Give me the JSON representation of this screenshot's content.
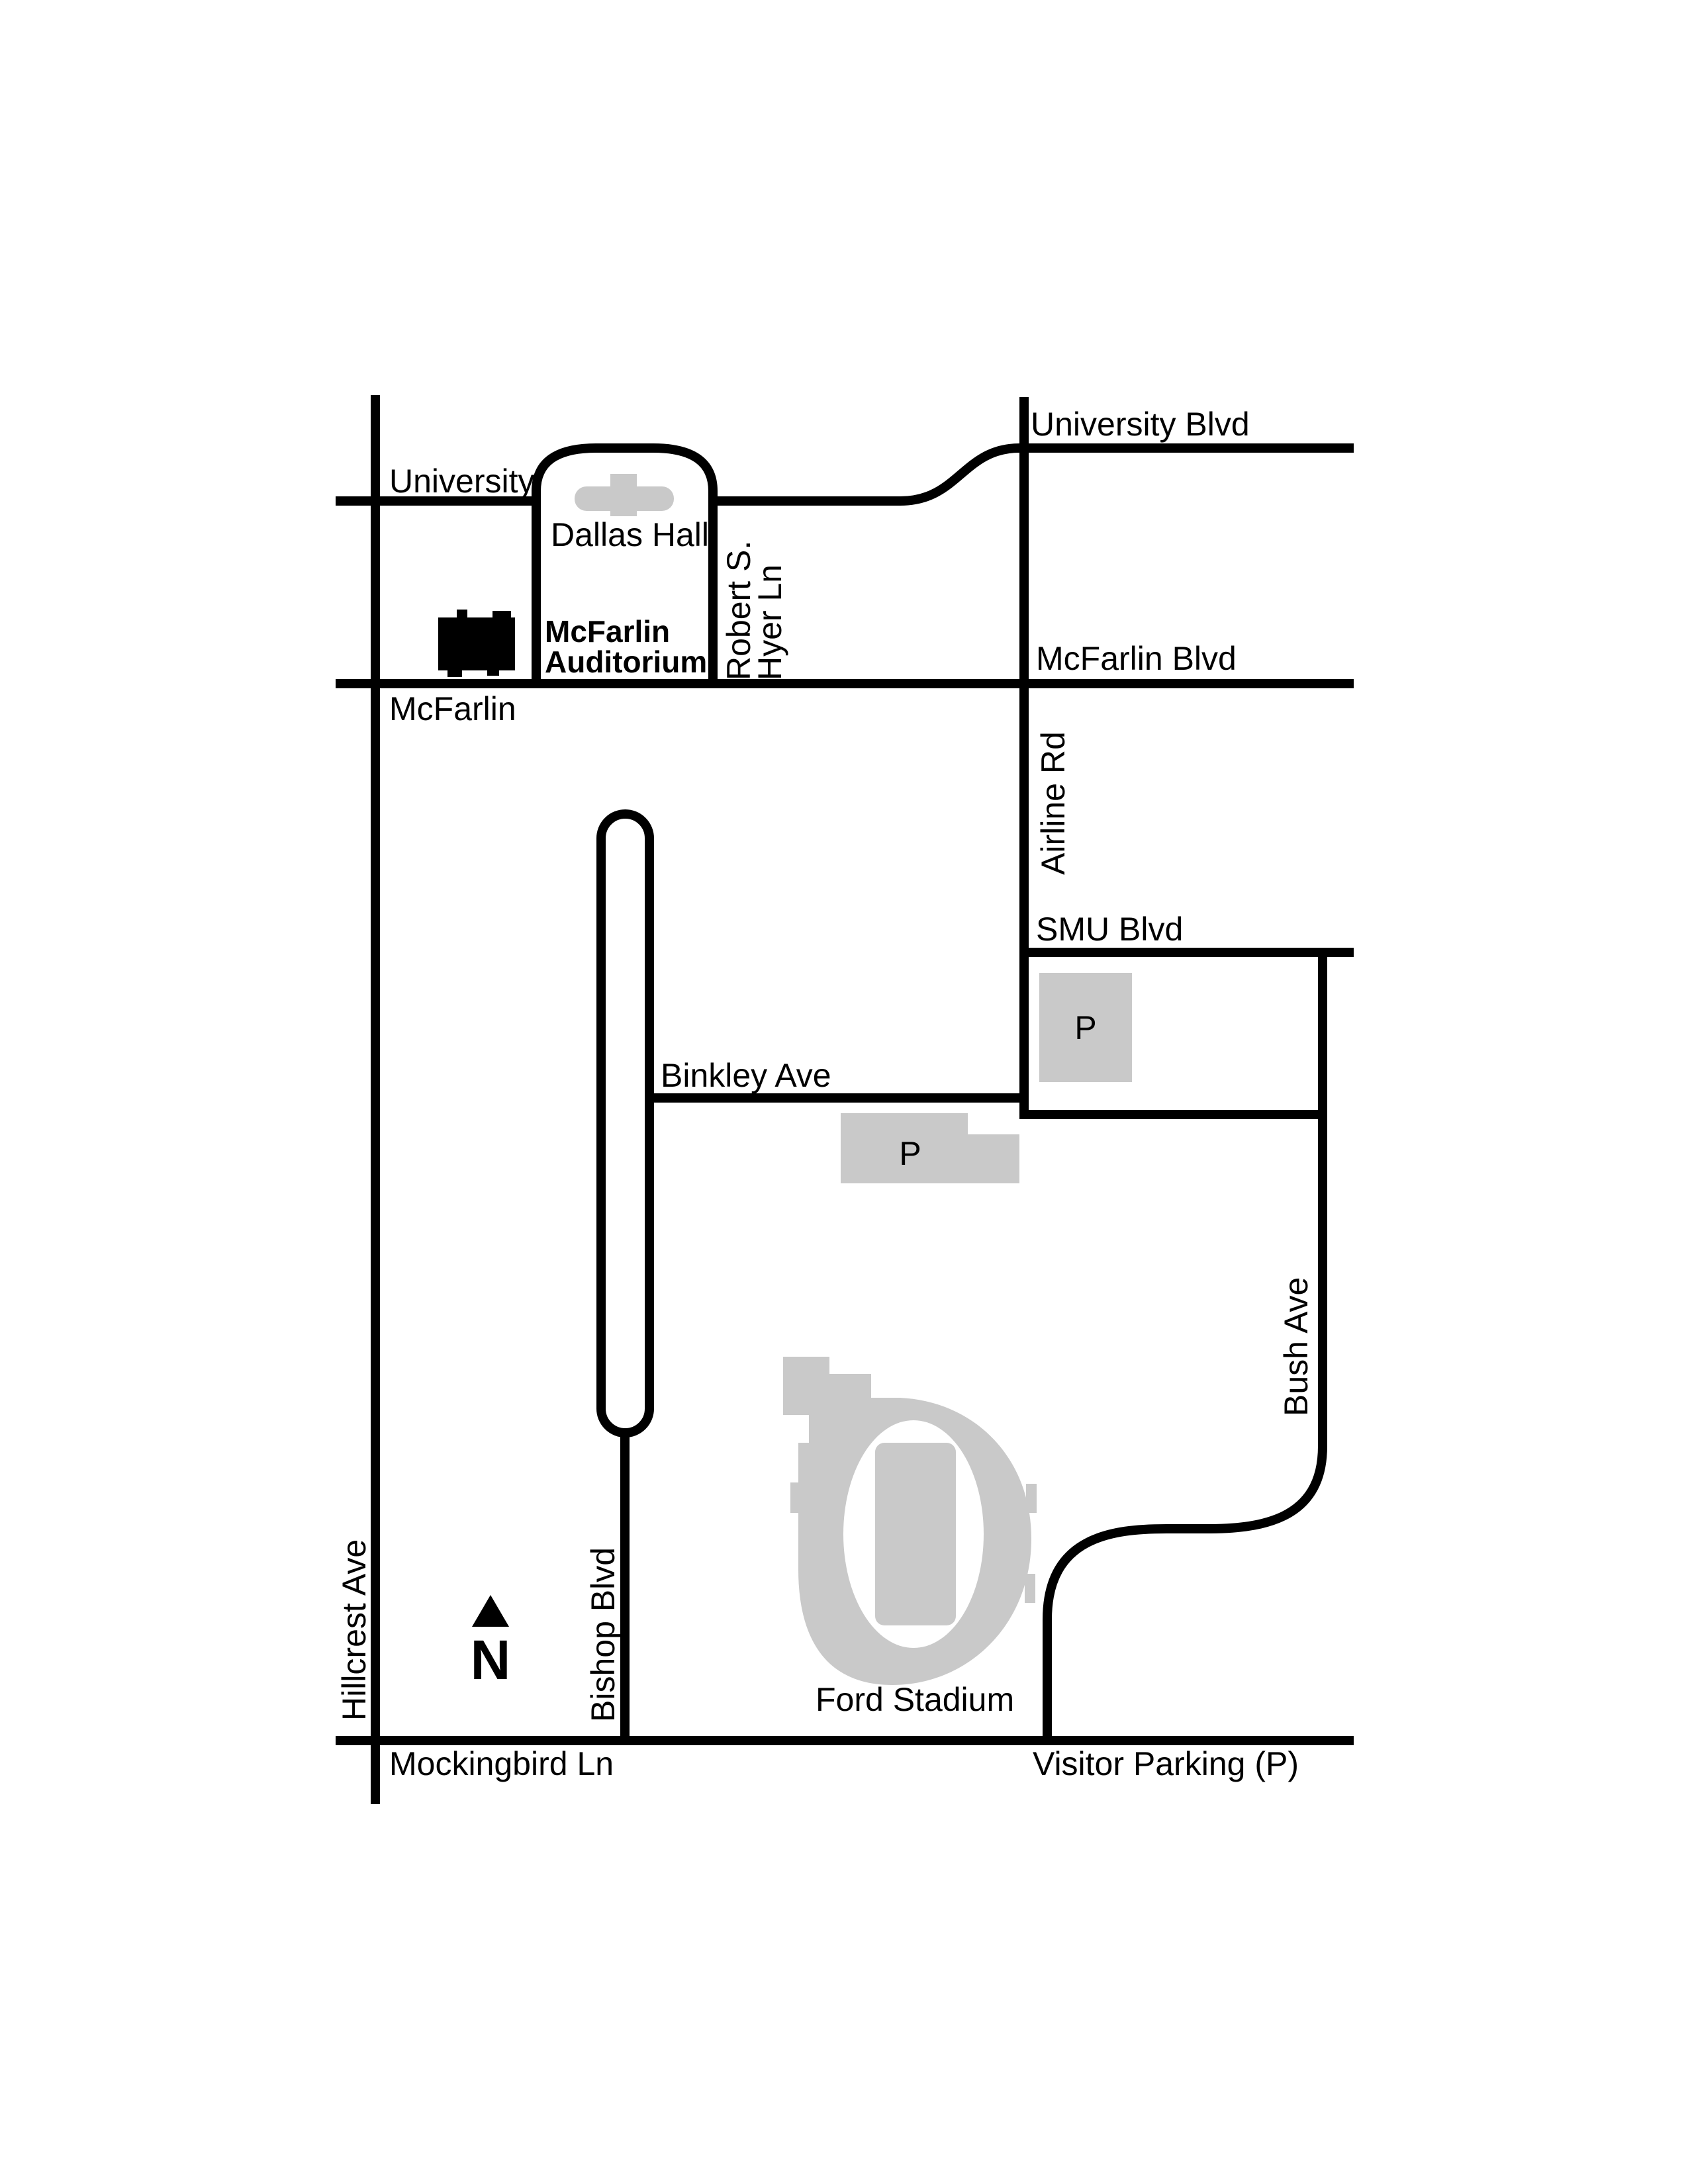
{
  "map": {
    "title": "SMU campus area map around McFarlin Auditorium",
    "colors": {
      "background": "#ffffff",
      "road": "#000000",
      "building_gray": "#c9c9c9",
      "building_black": "#000000",
      "text": "#000000"
    },
    "labels": {
      "university_blvd": "University Blvd",
      "university": "University",
      "dallas_hall": "Dallas Hall",
      "mcfarlin_auditorium_line1": "McFarlin",
      "mcfarlin_auditorium_line2": "Auditorium",
      "robert_s_hyer_line1": "Robert S.",
      "robert_s_hyer_line2": "Hyer Ln",
      "mcfarlin_street": "McFarlin",
      "mcfarlin_blvd": "McFarlin Blvd",
      "airline_rd": "Airline Rd",
      "smu_blvd": "SMU Blvd",
      "parking_upper": "P",
      "binkley_ave": "Binkley Ave",
      "parking_lower": "P",
      "bush_ave": "Bush Ave",
      "bishop_blvd": "Bishop Blvd",
      "hillcrest_ave": "Hillcrest Ave",
      "ford_stadium": "Ford Stadium",
      "mockingbird_ln": "Mockingbird Ln",
      "visitor_parking": "Visitor Parking (P)",
      "north_letter": "N"
    }
  }
}
